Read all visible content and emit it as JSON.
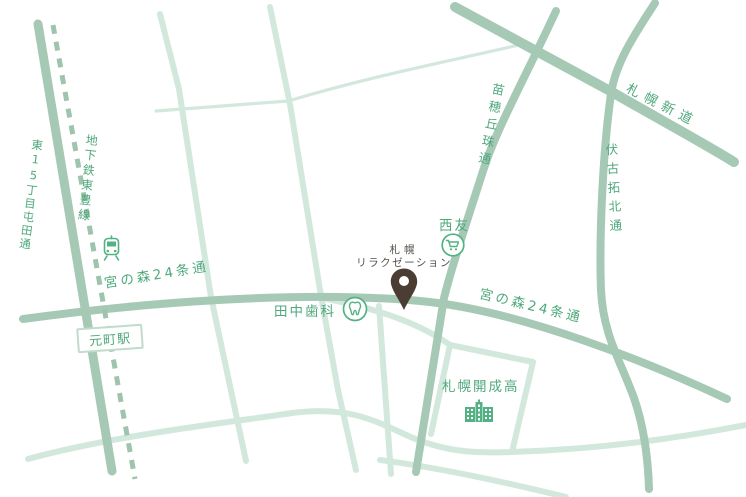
{
  "map": {
    "title": "Sapporo relaxation shop access map",
    "road_labels": {
      "higashi15_tonden": "東15丁目屯田通",
      "toho_subway_line": "地下鉄東豊線",
      "miyanomori24_left": "宮の森24条通",
      "miyanomori24_right": "宮の森24条通",
      "naebo_okadama": "苗穂丘珠通",
      "sapporo_shindo": "札幌新道",
      "fushiko_takuhoku": "伏古拓北通"
    },
    "places": {
      "motomachi_station": "元町駅",
      "tanaka_dental": "田中歯科",
      "seiyu": "西友",
      "sapporo_kaisei_high": "札幌開成高",
      "destination_line1": "札幌",
      "destination_line2": "リラクゼーション"
    },
    "icons": {
      "train": "train-icon",
      "cart": "shopping-cart-icon",
      "tooth": "tooth-icon",
      "school": "school-building-icon",
      "pin": "location-pin-icon"
    },
    "colors": {
      "road_medium": "#a6c9b5",
      "road_light": "#d3e8dc",
      "subway_dash": "#9fc4ad",
      "label_green": "#4fa87c",
      "destination_text": "#55524b",
      "pin_brown": "#4b3c34",
      "icon_green": "#54b183",
      "station_border": "#bfdccc"
    }
  }
}
